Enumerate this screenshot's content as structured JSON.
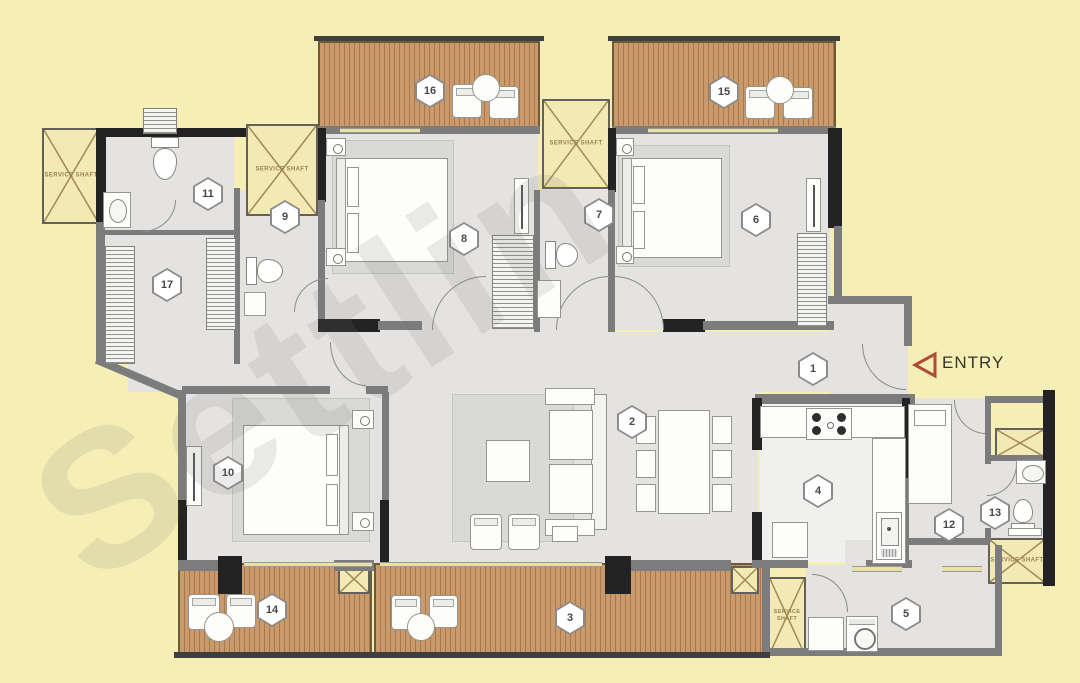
{
  "labels": {
    "entry": "ENTRY",
    "service_shaft": "SERVICE SHAFT",
    "watermark": "Settlin"
  },
  "markers": {
    "m1": "1",
    "m2": "2",
    "m3": "3",
    "m4": "4",
    "m5": "5",
    "m6": "6",
    "m7": "7",
    "m8": "8",
    "m9": "9",
    "m10": "10",
    "m11": "11",
    "m12": "12",
    "m13": "13",
    "m14": "14",
    "m15": "15",
    "m16": "16",
    "m17": "17"
  },
  "colors": {
    "background": "#f6efb5",
    "floor": "#e4e3e1",
    "deck_wood": "#c89a6c",
    "wall": "#7c7c7c",
    "wall_dark": "#232323",
    "shaft_fill": "#f3e9b4",
    "entry_accent": "#b14a38"
  }
}
